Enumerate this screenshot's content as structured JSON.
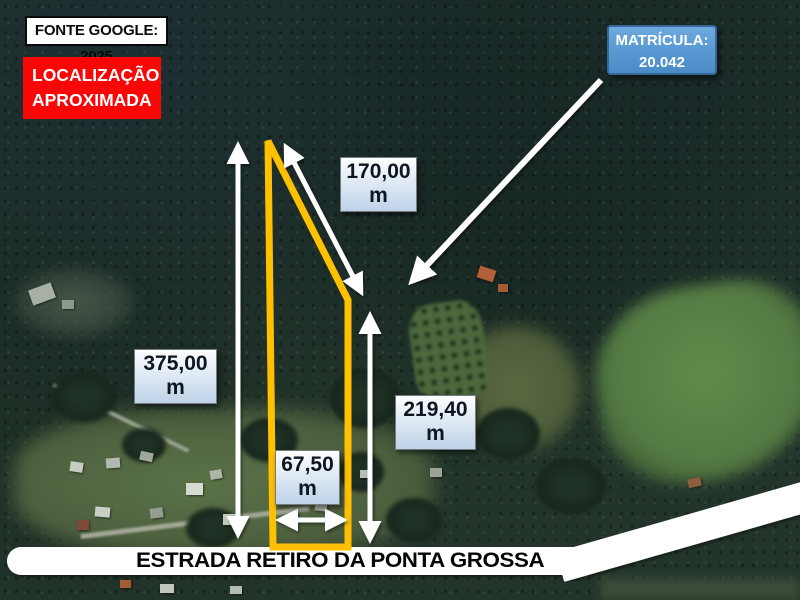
{
  "canvas": {
    "width": 800,
    "height": 600
  },
  "source_tag": {
    "label": "FONTE GOOGLE: 2025"
  },
  "location_badge": {
    "line1": "LOCALIZAÇÃO",
    "line2": "APROXIMADA"
  },
  "matricula_badge": {
    "line1": "MATRÍCULA:",
    "line2": "20.042"
  },
  "measurements": {
    "left_side": {
      "value": "375,00",
      "unit": "m"
    },
    "upper_diagonal": {
      "value": "170,00",
      "unit": "m"
    },
    "right_side": {
      "value": "219,40",
      "unit": "m"
    },
    "frontage": {
      "value": "67,50",
      "unit": "m"
    }
  },
  "road": {
    "name": "ESTRADA RETIRO DA PONTA GROSSA"
  },
  "colors": {
    "parcel_outline": "#ffc000",
    "badge_red": "#f90606",
    "badge_blue": "#5b9bd5",
    "arrow_white": "#ffffff",
    "road_band": "#ffffff"
  }
}
